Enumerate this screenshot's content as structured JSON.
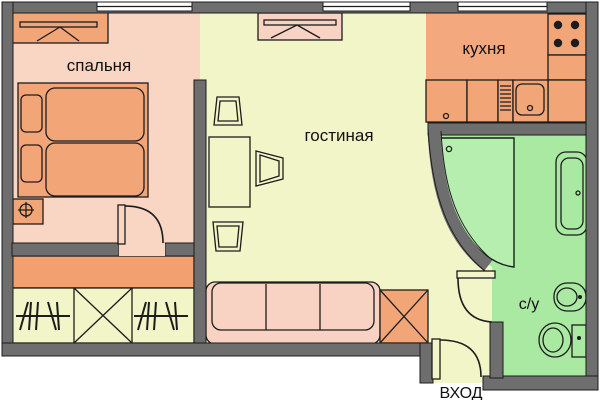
{
  "plan": {
    "title": "Однокомнатная квартира — план",
    "labels": {
      "bedroom": "спальня",
      "living": "гостиная",
      "kitchen": "кухня",
      "bathroom": "с/у",
      "entrance": "ВХОД"
    }
  },
  "colors": {
    "wall": "#6e6e6e",
    "outline": "#1c1c1c",
    "bedroom_floor": "#f9d6c4",
    "living_floor": "#f1f5c8",
    "kitchen_floor": "#f3a87d",
    "corridor_band": "#f3a071",
    "bathroom_floor": "#a9e9a2",
    "shower_tray": "#b5eeae",
    "furniture_orange": "#f2a577",
    "furniture_pink": "#f8d3c4",
    "window": "#ffffff",
    "text": "#111111"
  }
}
